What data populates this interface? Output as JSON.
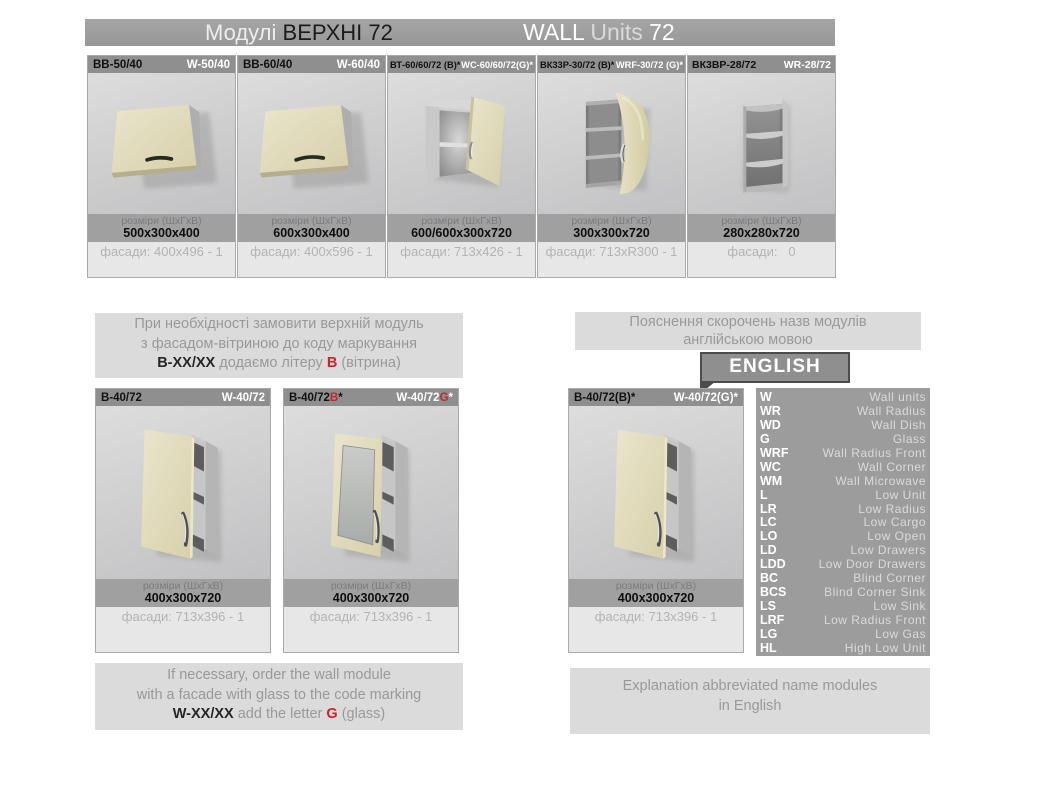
{
  "header": {
    "title_uk": {
      "light": "Модулі",
      "bold": "ВЕРХНІ 72"
    },
    "title_en": {
      "bold": "WALL",
      "light": "Units",
      "num": "72"
    }
  },
  "labels": {
    "dims": "розміри (ШхГхВ)"
  },
  "top_modules": [
    {
      "code_uk": "ВВ-50/40",
      "code_en": "W-50/40",
      "dims": "500x300x400",
      "facades": "фасади: 400x496 - 1"
    },
    {
      "code_uk": "ВВ-60/40",
      "code_en": "W-60/40",
      "dims": "600x300x400",
      "facades": "фасади: 400x596 - 1"
    },
    {
      "code_uk": "ВТ-60/60/72 (В)*",
      "code_en": "WC-60/60/72(G)*",
      "dims": "600/600x300x720",
      "facades": "фасади: 713x426 - 1"
    },
    {
      "code_uk": "ВК33Р-30/72 (В)*",
      "code_en": "WRF-30/72 (G)*",
      "dims": "300x300x720",
      "facades": "фасади: 713xR300 - 1"
    },
    {
      "code_uk": "ВК3ВР-28/72",
      "code_en": "WR-28/72",
      "dims": "280x280x720",
      "facades": "фасади:   0"
    }
  ],
  "note_uk": {
    "line1": "При необхідності замовити верхній модуль",
    "line2": "з фасадом-вітриною до коду маркування",
    "code": "В-ХХ/ХХ",
    "mid": " додаємо літеру ",
    "letter": "В",
    "tail": " (вітрина)"
  },
  "legend": {
    "heading_line1": "Пояснення скорочень назв модулів",
    "heading_line2": "англійською мовою",
    "badge": "ENGLISH",
    "items": [
      {
        "abbr": "W",
        "meaning": "Wall units"
      },
      {
        "abbr": "WR",
        "meaning": "Wall Radius"
      },
      {
        "abbr": "WD",
        "meaning": "Wall Dish"
      },
      {
        "abbr": "G",
        "meaning": "Glass"
      },
      {
        "abbr": "WRF",
        "meaning": "Wall Radius Front"
      },
      {
        "abbr": "WC",
        "meaning": "Wall Corner"
      },
      {
        "abbr": "WM",
        "meaning": "Wall Microwave"
      },
      {
        "abbr": "L",
        "meaning": "Low Unit"
      },
      {
        "abbr": "LR",
        "meaning": "Low Radius"
      },
      {
        "abbr": "LC",
        "meaning": "Low Cargo"
      },
      {
        "abbr": "LO",
        "meaning": "Low Open"
      },
      {
        "abbr": "LD",
        "meaning": "Low Drawers"
      },
      {
        "abbr": "LDD",
        "meaning": "Low Door Drawers"
      },
      {
        "abbr": "BC",
        "meaning": "Blind Corner"
      },
      {
        "abbr": "BCS",
        "meaning": "Blind Corner Sink"
      },
      {
        "abbr": "LS",
        "meaning": "Low Sink"
      },
      {
        "abbr": "LRF",
        "meaning": "Low Radius Front"
      },
      {
        "abbr": "LG",
        "meaning": "Low Gas"
      },
      {
        "abbr": "HL",
        "meaning": "High Low Unit"
      }
    ]
  },
  "bottom_modules": [
    {
      "uk_base": "В-40/72",
      "uk_red": "",
      "uk_tail": "",
      "en_base": "W-40/72",
      "en_red": "",
      "en_tail": "",
      "dims": "400x300x720",
      "facades": "фасади: 713x396 - 1"
    },
    {
      "uk_base": "В-40/72",
      "uk_red": "В",
      "uk_tail": "*",
      "en_base": "W-40/72",
      "en_red": "G",
      "en_tail": "*",
      "dims": "400x300x720",
      "facades": "фасади: 713x396 - 1"
    },
    {
      "uk_base": "В-40/72(В)*",
      "uk_red": "",
      "uk_tail": "",
      "en_base": "W-40/72(G)*",
      "en_red": "",
      "en_tail": "",
      "dims": "400x300x720",
      "facades": "фасади: 713x396 - 1"
    }
  ],
  "note_en": {
    "line1": "If necessary, order the wall module",
    "line2": "with a facade with glass to the code marking",
    "code": "W-XX/XX",
    "mid": " add the letter ",
    "letter": "G",
    "tail": " (glass)"
  },
  "footer_en": {
    "line1": "Explanation abbreviated name modules",
    "line2": "in English"
  },
  "colors": {
    "accent_red": "#c9242b",
    "panel_gray": "#9c9c9c",
    "bar_gray": "#8f8f8f",
    "box_gray": "#dbdbdb"
  }
}
